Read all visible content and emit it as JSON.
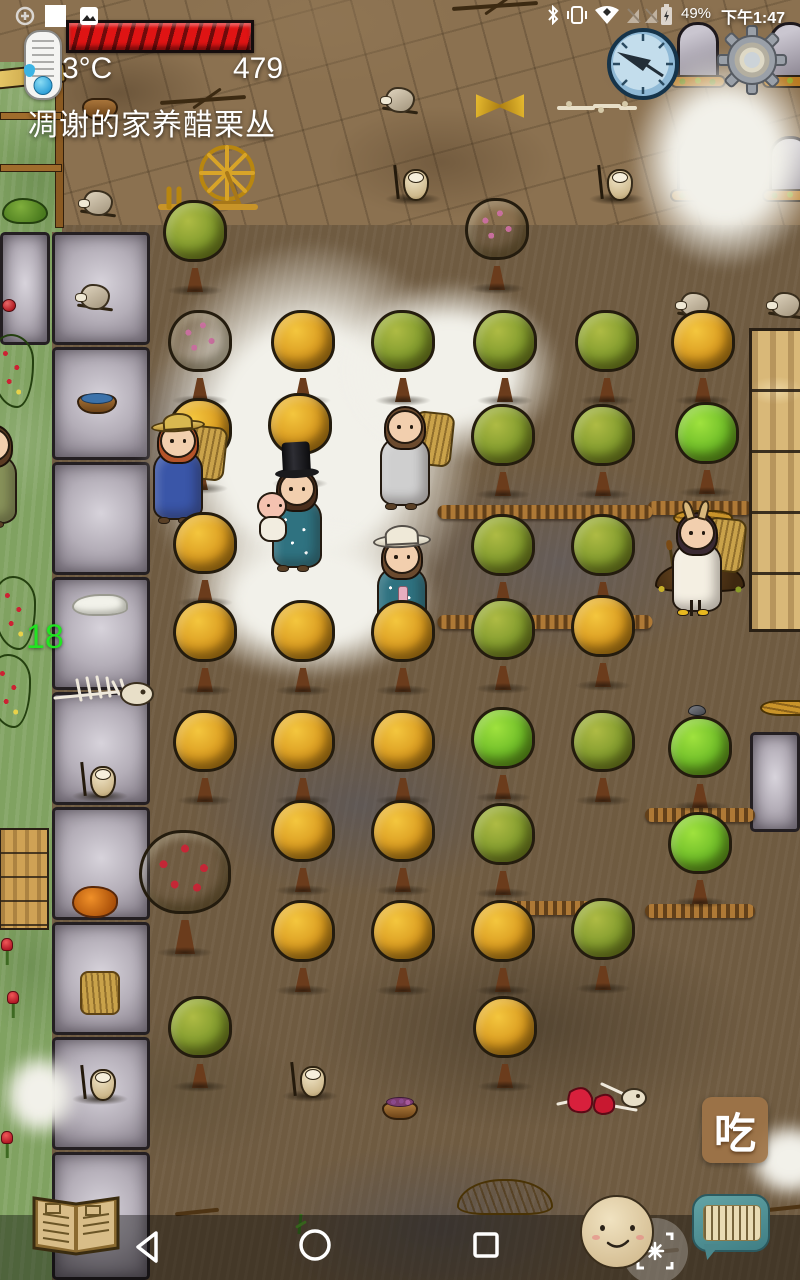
{
  "status": {
    "time": "下午1:47",
    "battery": "49%",
    "left_icons": [
      "data-saver-icon",
      "screenshot-square-icon",
      "photo-icon"
    ],
    "right_icons": [
      "bluetooth-icon",
      "vibrate-icon",
      "wifi-icon",
      "no-sim-icon",
      "battery-charging-icon"
    ]
  },
  "hud": {
    "temperature": "3°C",
    "counter": "479",
    "caption": "凋谢的家养醋栗丛",
    "age": "18",
    "eat_label": "吃",
    "food_segments": 14,
    "food_color": "#df1414",
    "age_color": "#21e421"
  },
  "nav": {
    "buttons": [
      "back-button",
      "home-button",
      "recents-button"
    ],
    "game_buttons": [
      "crafting-book-button",
      "emote-face-button",
      "capture-button",
      "chat-keyboard-button",
      "eat-button",
      "compass-clock-button",
      "settings-gear-button"
    ]
  },
  "colors": {
    "dirt": "#8b7150",
    "mud": "#6f5b41",
    "grass": "#80a261",
    "road_tile": "#b4aeb8",
    "snow": "#f2f1ea",
    "withered_tree": "#d99a1f",
    "green_tree": "#7f992c",
    "fresh_tree": "#6cbb27",
    "cape_teal": "#2f7280",
    "ui_teal": "#4f9296",
    "eat_brown": "#9e7448"
  },
  "scene": {
    "road_tiles": [
      {
        "x": 0,
        "y": 232,
        "w": 50,
        "h": 113
      },
      {
        "x": 52,
        "y": 232,
        "w": 98,
        "h": 113
      },
      {
        "x": 52,
        "y": 347,
        "w": 98,
        "h": 113
      },
      {
        "x": 52,
        "y": 462,
        "w": 98,
        "h": 113
      },
      {
        "x": 52,
        "y": 577,
        "w": 98,
        "h": 113
      },
      {
        "x": 52,
        "y": 692,
        "w": 98,
        "h": 113
      },
      {
        "x": 52,
        "y": 807,
        "w": 98,
        "h": 113
      },
      {
        "x": 52,
        "y": 922,
        "w": 98,
        "h": 113
      },
      {
        "x": 52,
        "y": 1037,
        "w": 98,
        "h": 113
      },
      {
        "x": 52,
        "y": 1152,
        "w": 98,
        "h": 128
      },
      {
        "x": 750,
        "y": 732,
        "w": 50,
        "h": 100
      }
    ],
    "grass_patches": [
      {
        "x": 0,
        "y": 232,
        "w": 52,
        "h": 1048
      },
      {
        "x": 0,
        "y": 62,
        "w": 62,
        "h": 170
      }
    ],
    "snow_patches": [
      {
        "x": 140,
        "y": 240,
        "w": 340,
        "h": 400,
        "z": 4
      },
      {
        "x": 180,
        "y": 520,
        "w": 260,
        "h": 160,
        "z": 4
      },
      {
        "x": 340,
        "y": 280,
        "w": 220,
        "h": 180,
        "z": 4
      },
      {
        "x": 630,
        "y": 50,
        "w": 190,
        "h": 220,
        "z": 260
      },
      {
        "x": 745,
        "y": 1120,
        "w": 90,
        "h": 80,
        "z": 6
      },
      {
        "x": 0,
        "y": 1050,
        "w": 80,
        "h": 90,
        "z": 6
      }
    ],
    "dirt_rows": [
      {
        "x": 545,
        "y": 512,
        "w": 215
      },
      {
        "x": 700,
        "y": 508,
        "w": 105
      },
      {
        "x": 545,
        "y": 622,
        "w": 215
      },
      {
        "x": 700,
        "y": 815,
        "w": 110
      },
      {
        "x": 700,
        "y": 911,
        "w": 110
      },
      {
        "x": 545,
        "y": 908,
        "w": 110
      }
    ],
    "objects": [
      {
        "type": "shelfrack",
        "x": 34,
        "y": 228
      },
      {
        "type": "branch",
        "x": 205,
        "y": 112
      },
      {
        "type": "branch",
        "x": 497,
        "y": 18
      },
      {
        "type": "pot",
        "x": 100,
        "y": 120
      },
      {
        "type": "stoneblock",
        "x": 98,
        "y": 218
      },
      {
        "type": "wheatbundle",
        "x": 500,
        "y": 120
      },
      {
        "type": "bonepile",
        "x": 597,
        "y": 116
      },
      {
        "type": "spinwheel",
        "x": 210,
        "y": 222
      },
      {
        "type": "owl",
        "x": 413,
        "y": 205
      },
      {
        "type": "owl",
        "x": 617,
        "y": 205
      },
      {
        "type": "grave",
        "x": 698,
        "y": 88
      },
      {
        "type": "grave",
        "x": 790,
        "y": 88
      },
      {
        "type": "grave",
        "x": 698,
        "y": 202
      },
      {
        "type": "grave",
        "x": 790,
        "y": 202
      },
      {
        "type": "stoneblock",
        "x": 400,
        "y": 115
      },
      {
        "type": "stoneblock",
        "x": 695,
        "y": 320
      },
      {
        "type": "stoneblock",
        "x": 786,
        "y": 320
      },
      {
        "type": "apple",
        "x": 9,
        "y": 312
      },
      {
        "type": "stoneblock",
        "x": 95,
        "y": 312
      },
      {
        "type": "bowl",
        "x": 97,
        "y": 414
      },
      {
        "type": "cloth",
        "x": 100,
        "y": 616
      },
      {
        "type": "skel",
        "x": 105,
        "y": 712
      },
      {
        "type": "owl",
        "x": 100,
        "y": 802
      },
      {
        "type": "owl",
        "x": 100,
        "y": 1105
      },
      {
        "type": "meat",
        "x": 95,
        "y": 918
      },
      {
        "type": "hay",
        "x": 100,
        "y": 1015
      },
      {
        "type": "woodfloor",
        "x": 24,
        "y": 930
      },
      {
        "type": "goose",
        "x": 12,
        "y": 910
      },
      {
        "type": "tulip",
        "x": 7,
        "y": 965
      },
      {
        "type": "tulip",
        "x": 13,
        "y": 1018
      },
      {
        "type": "tulip",
        "x": 7,
        "y": 1158
      },
      {
        "type": "berrybush",
        "x": 13,
        "y": 408
      },
      {
        "type": "berrybush",
        "x": 15,
        "y": 650
      },
      {
        "type": "berrybush",
        "x": 10,
        "y": 728
      },
      {
        "type": "rock",
        "x": 600,
        "y": 330
      },
      {
        "type": "rock",
        "x": 697,
        "y": 716
      },
      {
        "type": "woodwall",
        "x": 776,
        "y": 632
      },
      {
        "type": "fish",
        "x": 770,
        "y": 462
      },
      {
        "type": "strawpile",
        "x": 703,
        "y": 526
      },
      {
        "type": "strawpile",
        "x": 788,
        "y": 526
      },
      {
        "type": "strawpile",
        "x": 790,
        "y": 716
      },
      {
        "type": "mound",
        "x": 700,
        "y": 594
      },
      {
        "type": "tree_green",
        "x": 195,
        "y": 296
      },
      {
        "type": "tree_berry",
        "x": 497,
        "y": 294
      },
      {
        "type": "tree_berry",
        "x": 200,
        "y": 406
      },
      {
        "type": "tree_orange",
        "x": 303,
        "y": 406
      },
      {
        "type": "tree_green",
        "x": 403,
        "y": 406
      },
      {
        "type": "tree_green",
        "x": 505,
        "y": 406
      },
      {
        "type": "tree_green",
        "x": 607,
        "y": 406
      },
      {
        "type": "tree_orange",
        "x": 703,
        "y": 406
      },
      {
        "type": "tree_orange",
        "x": 200,
        "y": 494
      },
      {
        "type": "tree_orange",
        "x": 300,
        "y": 489
      },
      {
        "type": "tree_green",
        "x": 503,
        "y": 500
      },
      {
        "type": "tree_green",
        "x": 603,
        "y": 500
      },
      {
        "type": "tree_bright",
        "x": 707,
        "y": 498
      },
      {
        "type": "tree_orange",
        "x": 205,
        "y": 608
      },
      {
        "type": "tree_green",
        "x": 503,
        "y": 610
      },
      {
        "type": "tree_green",
        "x": 603,
        "y": 610
      },
      {
        "type": "tree_orange",
        "x": 205,
        "y": 696
      },
      {
        "type": "tree_orange",
        "x": 303,
        "y": 696
      },
      {
        "type": "tree_orange",
        "x": 403,
        "y": 696
      },
      {
        "type": "tree_green",
        "x": 503,
        "y": 694
      },
      {
        "type": "tree_orange",
        "x": 603,
        "y": 691
      },
      {
        "type": "tree_orange",
        "x": 205,
        "y": 806
      },
      {
        "type": "tree_orange",
        "x": 303,
        "y": 806
      },
      {
        "type": "tree_orange",
        "x": 403,
        "y": 806
      },
      {
        "type": "tree_bright",
        "x": 503,
        "y": 803
      },
      {
        "type": "tree_green",
        "x": 603,
        "y": 806
      },
      {
        "type": "tree_bright",
        "x": 700,
        "y": 812
      },
      {
        "type": "tree_orange",
        "x": 303,
        "y": 896
      },
      {
        "type": "tree_orange",
        "x": 403,
        "y": 896
      },
      {
        "type": "tree_green",
        "x": 503,
        "y": 899
      },
      {
        "type": "tree_bright",
        "x": 700,
        "y": 908
      },
      {
        "type": "tree_apple",
        "x": 185,
        "y": 958
      },
      {
        "type": "tree_orange",
        "x": 303,
        "y": 996
      },
      {
        "type": "tree_orange",
        "x": 403,
        "y": 996
      },
      {
        "type": "tree_orange",
        "x": 503,
        "y": 996
      },
      {
        "type": "tree_green",
        "x": 603,
        "y": 994
      },
      {
        "type": "tree_green",
        "x": 200,
        "y": 1092
      },
      {
        "type": "tree_orange",
        "x": 505,
        "y": 1092
      },
      {
        "type": "owl",
        "x": 310,
        "y": 1102
      },
      {
        "type": "basket",
        "x": 400,
        "y": 1120
      },
      {
        "type": "meatbones",
        "x": 600,
        "y": 1120
      },
      {
        "type": "stickobj",
        "x": 198,
        "y": 1218
      },
      {
        "type": "sprout",
        "x": 300,
        "y": 1234
      },
      {
        "type": "wheatpile",
        "x": 505,
        "y": 1215
      },
      {
        "type": "stickobj",
        "x": 658,
        "y": 1258
      },
      {
        "type": "stickobj",
        "x": 788,
        "y": 1214
      }
    ],
    "characters": [
      {
        "x": 178,
        "y": 524,
        "hat": "straw",
        "hair": "#b5542a",
        "dress": "#3a56a8",
        "dots": false,
        "backpack": true,
        "baby": false,
        "shoe": "#5a4026"
      },
      {
        "x": 297,
        "y": 572,
        "hat": "top",
        "hair": "#4a2e1c",
        "dress": "#2f7280",
        "dots": true,
        "backpack": false,
        "baby": true,
        "shoe": "#5a4026"
      },
      {
        "x": 405,
        "y": 510,
        "hat": "none",
        "hair": "#6b4a2e",
        "dress": "#cfcfcf",
        "dots": false,
        "backpack": true,
        "baby": false,
        "shoe": "#5a4026"
      },
      {
        "x": 402,
        "y": 640,
        "hat": "sun",
        "hair": "#6b4a2e",
        "dress": "#2f7280",
        "dots": true,
        "backpack": false,
        "baby": false,
        "ribbon": true,
        "shoe": "#5a4026"
      },
      {
        "x": 697,
        "y": 616,
        "hat": "ears",
        "hair": "#3a2a33",
        "dress": "#f4efe2",
        "dots": false,
        "backpack": true,
        "baby": false,
        "legs": true,
        "shoe": "#e8b820"
      },
      {
        "x": -8,
        "y": 528,
        "hat": "none",
        "hair": "#5a3a22",
        "dress": "#88925a",
        "dots": false,
        "backpack": false,
        "baby": false,
        "shoe": "#5a4026"
      }
    ]
  }
}
